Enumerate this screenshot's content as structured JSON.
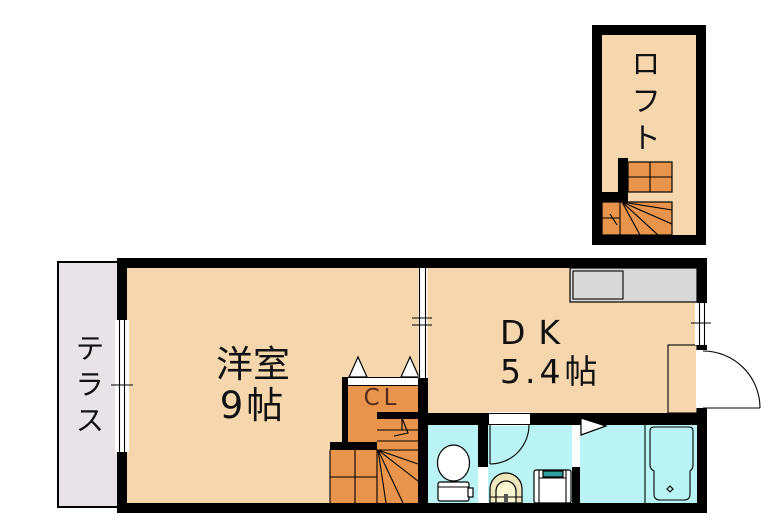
{
  "page": {
    "type": "apartment-floor-plan"
  },
  "colors": {
    "wall": "#000000",
    "room_fill": "#f6d7ad",
    "stairs_fill": "#e8944c",
    "wet_area_fill": "#b9f3f3",
    "terrace_fill": "#e7e3e7",
    "counter_fill": "#d9d9d9",
    "entry_fill": "#dedade",
    "basin_outer": "#efe8bd",
    "basin_inner": "#fbf6d2",
    "washer_accent": "#2fa0a0",
    "closet_text_color": "#542a1c"
  },
  "rooms": {
    "loft": {
      "label": "ロフト"
    },
    "terrace": {
      "label": "テラス"
    },
    "western_room": {
      "label": "洋室",
      "size": "9帖"
    },
    "dining_kitchen": {
      "label": "DK",
      "size": "5.4帖"
    },
    "closet": {
      "label": "CL"
    }
  },
  "fixtures": {
    "kitchen_counter": "kitchen-counter-with-sink",
    "toilet": "toilet",
    "washbasin": "washbasin",
    "washing_machine": "washing-machine-pan",
    "bathtub": "bathtub",
    "staircase_main": "winder-staircase",
    "staircase_loft": "loft-winder-staircase",
    "entrance_door": "entrance-swing-door",
    "washroom_door": "washroom-swing-door",
    "bathroom_door": "bathroom-door",
    "closet_doors": "closet-double-doors",
    "windows": "windows-with-center-tick"
  }
}
